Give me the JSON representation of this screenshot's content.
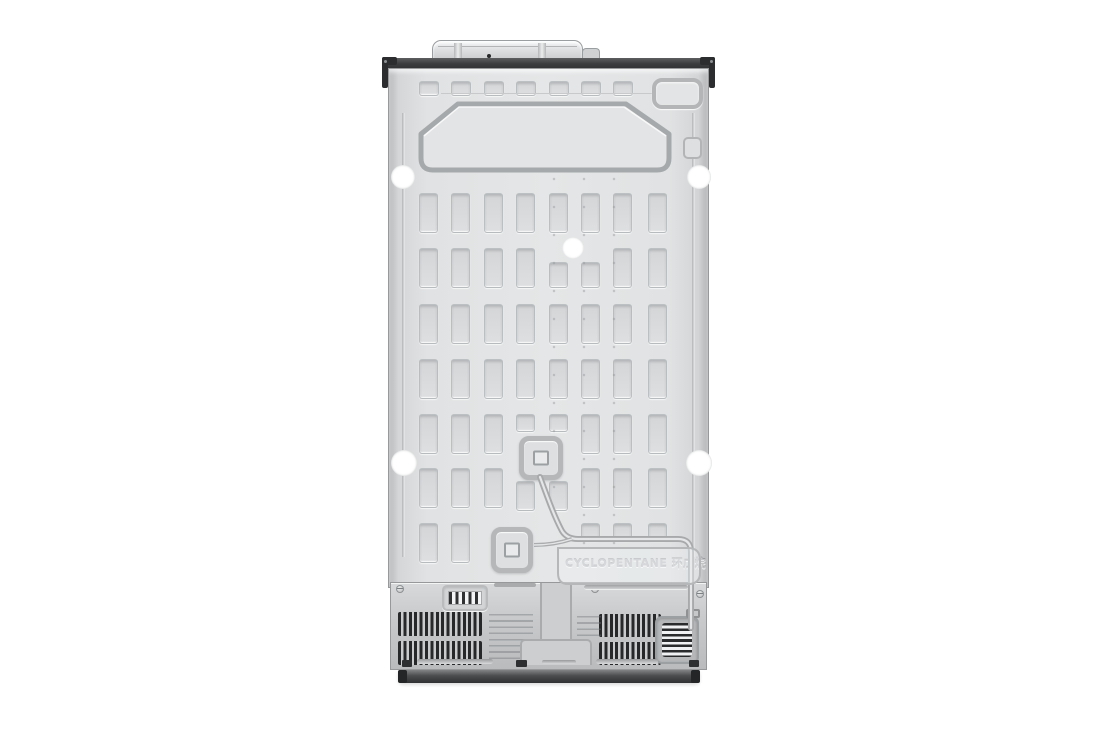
{
  "scene": {
    "type": "product-photo",
    "subject": "refrigerator rear view on white background",
    "background": "#ffffff"
  },
  "labels": {
    "refrigerant": "CYCLOPENTANE 环戊烷"
  },
  "colors": {
    "panel": "#e2e4e5",
    "panel_shadow": "#b2b4b6",
    "emboss_line": "#a6a9ab",
    "trim_dark": "#3a3c3e",
    "cover": "#c9cbcd",
    "vent_slat": "#26282a",
    "base": "#3d3f41",
    "hole": "#ffffff"
  },
  "emboss_pattern": {
    "columns": [
      30,
      62,
      95,
      127,
      160,
      192,
      224,
      259
    ],
    "rows": [
      124,
      179,
      235,
      290,
      345,
      399,
      454
    ],
    "cell_w": 19,
    "cell_h": 40,
    "top_row": {
      "y": 12,
      "w": 20,
      "h": 15,
      "count": 7
    },
    "mods": [
      {
        "r": 1,
        "c": 4,
        "dy": 14,
        "h": 26
      },
      {
        "r": 1,
        "c": 5,
        "dy": 14,
        "h": 26
      },
      {
        "r": 4,
        "c": 3,
        "h": 18
      },
      {
        "r": 4,
        "c": 4,
        "h": 18
      },
      {
        "r": 5,
        "c": 3,
        "dy": 13,
        "h": 30
      },
      {
        "r": 5,
        "c": 4,
        "dy": 13,
        "h": 30
      },
      {
        "r": 6,
        "c": 5,
        "h": 18
      },
      {
        "r": 6,
        "c": 6,
        "h": 18
      },
      {
        "r": 6,
        "c": 7,
        "h": 18
      }
    ],
    "skip": [
      [
        6,
        2
      ],
      [
        6,
        3
      ],
      [
        6,
        4
      ]
    ]
  }
}
